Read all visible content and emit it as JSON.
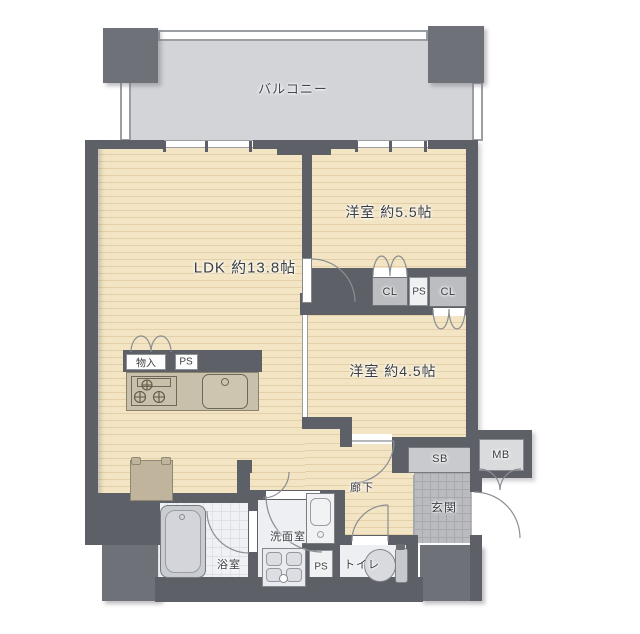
{
  "plan_labels": {
    "balcony": "バルコニー",
    "ldk": "LDK 約13.8帖",
    "bedroom1": "洋室 約5.5帖",
    "bedroom2": "洋室 約4.5帖",
    "closet1": "CL",
    "ps_mid": "PS",
    "closet2": "CL",
    "storage": "物入",
    "ps_kitchen": "PS",
    "hallway": "廊下",
    "entrance": "玄関",
    "shoebox": "SB",
    "meterbox": "MB",
    "bathroom": "浴室",
    "washroom": "洗面室",
    "ps_bottom": "PS",
    "toilet": "トイレ"
  },
  "colors": {
    "wall": "#5d6066",
    "pillar": "#6e7177",
    "balcony_floor": "#d2d4d8",
    "room_floor": "#f3e5c4",
    "closet_box": "#bcbdc1",
    "entrance_tile": "#b9bbbf",
    "wet_floor": "#edeff3",
    "kitchen_counter": "#c8c0aa",
    "text": "#3b3d42"
  }
}
